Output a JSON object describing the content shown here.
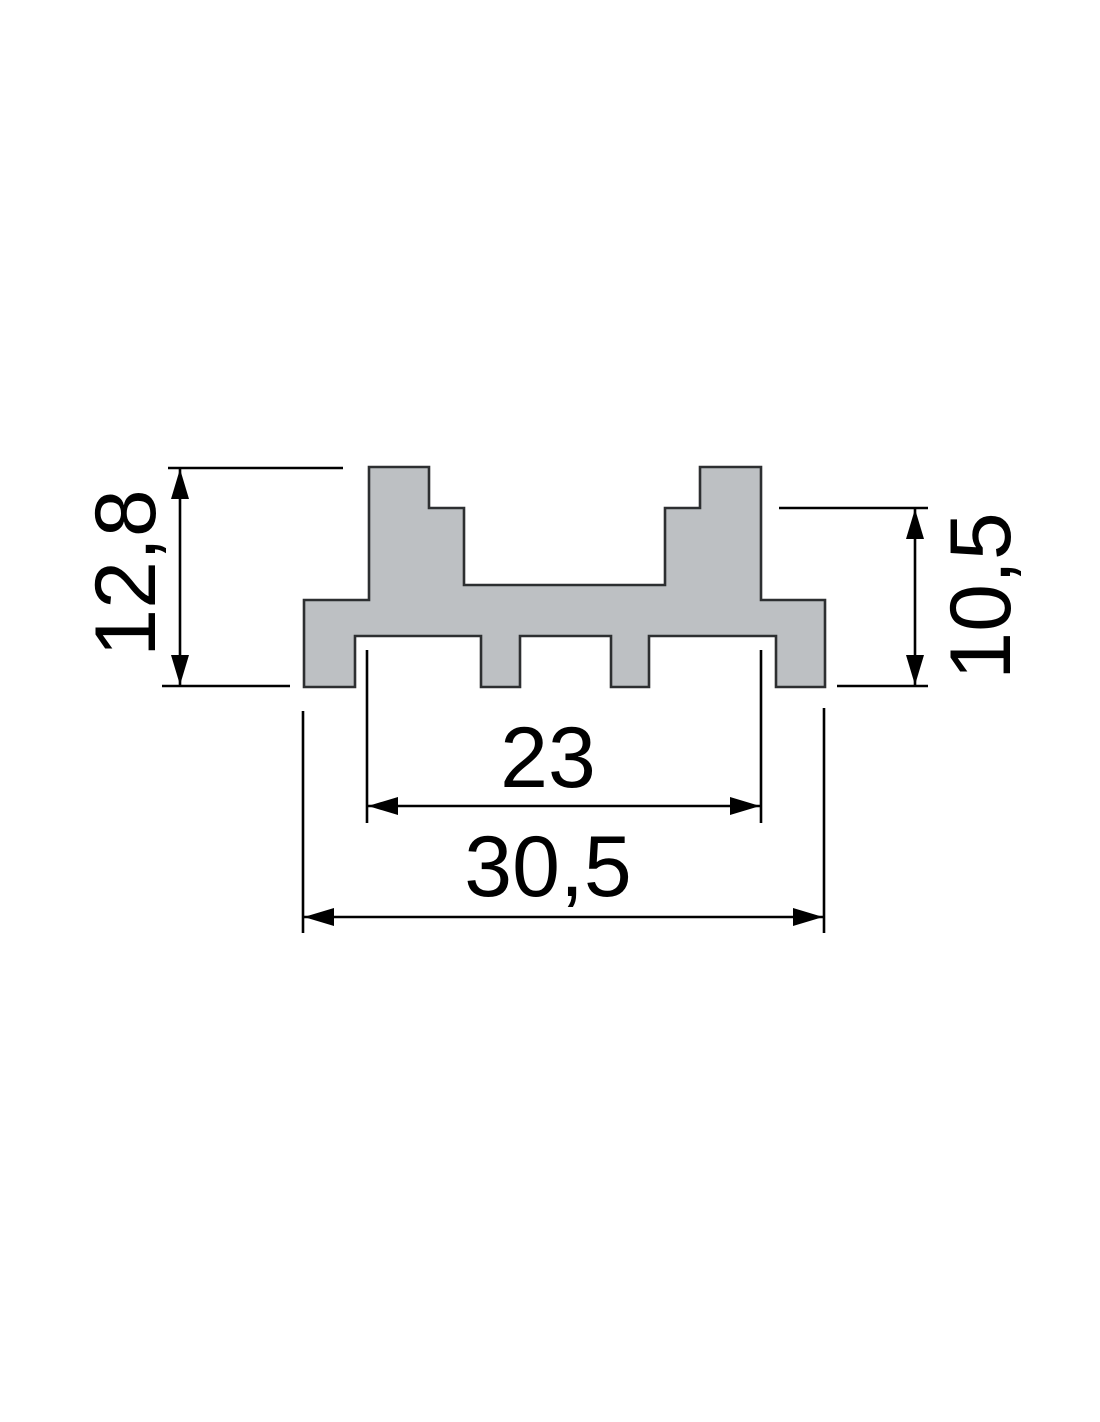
{
  "drawing": {
    "colors": {
      "background": "#ffffff",
      "profile_fill": "#bdc0c3",
      "profile_outline": "#2d2f31",
      "dimension_lines": "#000000"
    },
    "dimensions": {
      "overall_height": {
        "label": "12,8"
      },
      "side_height": {
        "label": "10,5"
      },
      "inner_width": {
        "label": "23"
      },
      "overall_width": {
        "label": "30,5"
      }
    }
  }
}
